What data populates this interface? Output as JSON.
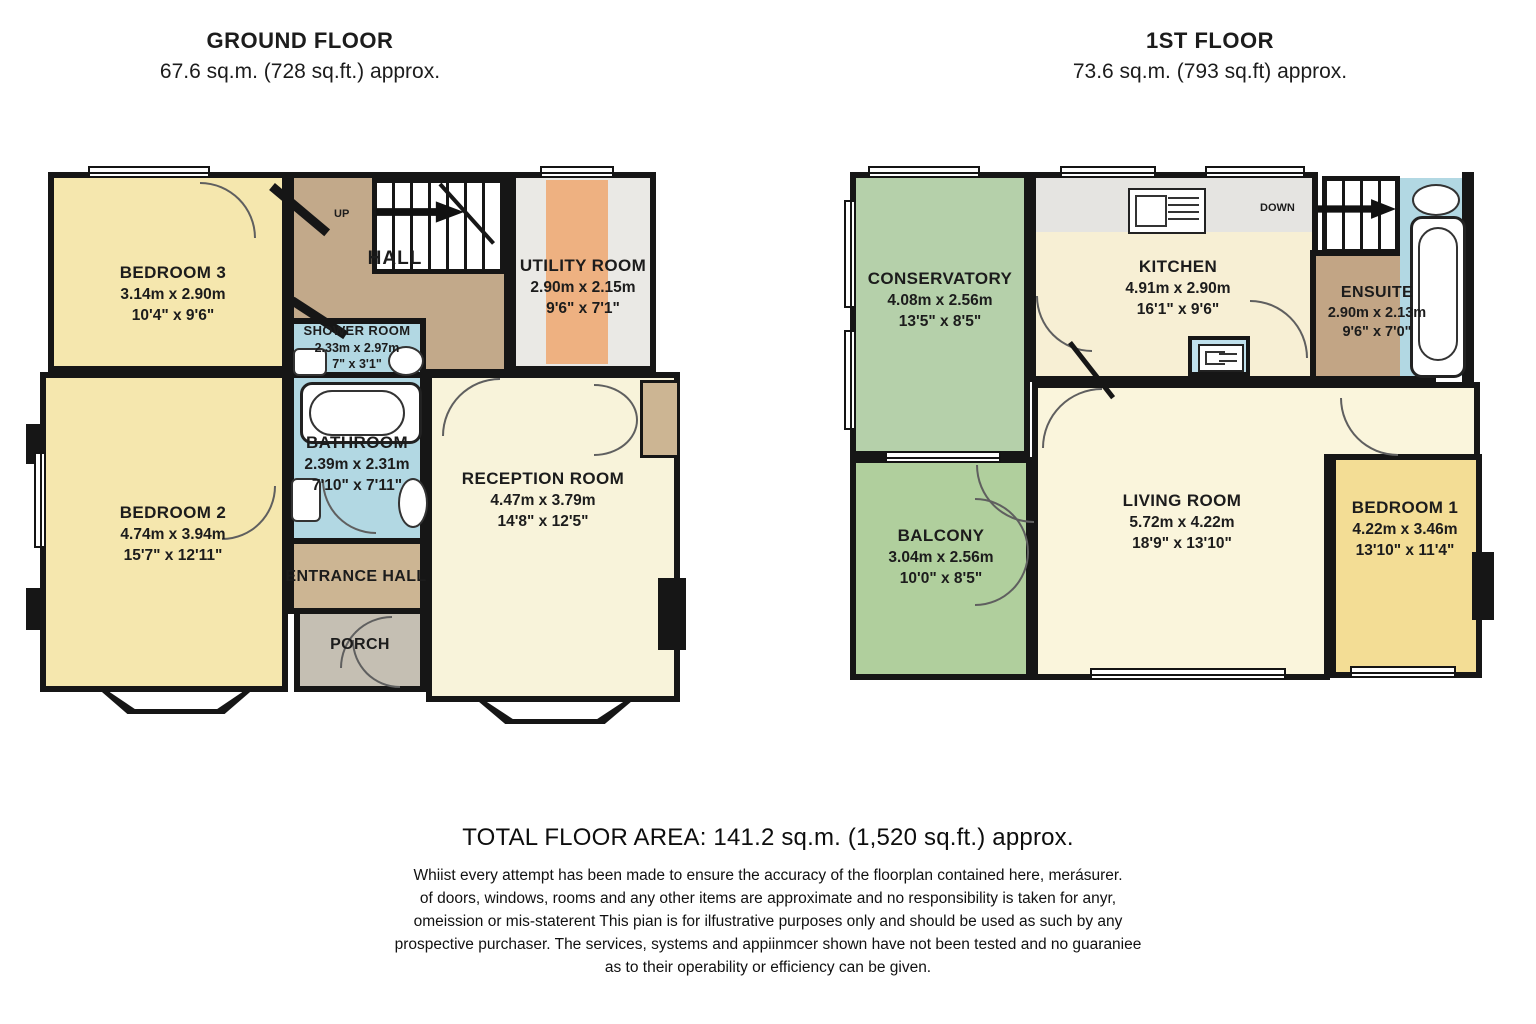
{
  "titles": {
    "ground": {
      "name": "GROUND FLOOR",
      "area": "67.6 sq.m. (728 sq.ft.) approx."
    },
    "first": {
      "name": "1ST FLOOR",
      "area": "73.6 sq.m. (793 sq.ft) approx."
    }
  },
  "ground_floor": {
    "bedroom3": {
      "name": "BEDROOM 3",
      "metric": "3.14m x 2.90m",
      "imperial": "10'4\" x 9'6\""
    },
    "hall": {
      "name": "HALL",
      "up_label": "UP"
    },
    "utility_room": {
      "name": "UTILITY ROOM",
      "metric": "2.90m x 2.15m",
      "imperial": "9'6\" x 7'1\""
    },
    "shower_room": {
      "name": "SHOWER ROOM",
      "metric": "2.33m x 2.97m",
      "imperial": "7\" x 3'1\""
    },
    "bathroom": {
      "name": "BATHROOM",
      "metric": "2.39m x 2.31m",
      "imperial": "7'10\" x 7'11\""
    },
    "bedroom2": {
      "name": "BEDROOM 2",
      "metric": "4.74m x 3.94m",
      "imperial": "15'7\" x 12'11\""
    },
    "entrance_hall": {
      "name": "ENTRANCE HALL"
    },
    "porch": {
      "name": "PORCH"
    },
    "reception_room": {
      "name": "RECEPTION ROOM",
      "metric": "4.47m x 3.79m",
      "imperial": "14'8\" x 12'5\""
    }
  },
  "first_floor": {
    "conservatory": {
      "name": "CONSERVATORY",
      "metric": "4.08m x 2.56m",
      "imperial": "13'5\" x 8'5\""
    },
    "kitchen": {
      "name": "KITCHEN",
      "metric": "4.91m x 2.90m",
      "imperial": "16'1\" x 9'6\""
    },
    "stairs": {
      "down_label": "DOWN"
    },
    "ensuite": {
      "name": "ENSUITE",
      "metric": "2.90m x 2.13m",
      "imperial": "9'6\" x 7'0\""
    },
    "balcony": {
      "name": "BALCONY",
      "metric": "3.04m x 2.56m",
      "imperial": "10'0\" x 8'5\""
    },
    "living_room": {
      "name": "LIVING ROOM",
      "metric": "5.72m x 4.22m",
      "imperial": "18'9\" x 13'10\""
    },
    "bedroom1": {
      "name": "BEDROOM 1",
      "metric": "4.22m x 3.46m",
      "imperial": "13'10\" x 11'4\""
    }
  },
  "footer": {
    "total_area": "TOTAL FLOOR AREA: 141.2 sq.m. (1,520 sq.ft.) approx.",
    "disclaimer": [
      "Whiist every attempt has been made to ensure the accuracy of the floorplan contained here, merásurer.",
      "of doors, windows, rooms and any other items are approximate and no responsibility is taken for anyr,",
      "omeission or mis-staterent This pian is for ilfustrative purposes only and should be used as such by any",
      "prospective purchaser. The services, systems and appiinmcer shown have not been tested and no guaraniee",
      "as to their operability or efficiency can be given."
    ]
  },
  "colors": {
    "wall": "#161616",
    "bedroom_yellow": "#f5e7ae",
    "bedroom1_yellow": "#f3dd95",
    "cream": "#f8f3da",
    "hall_tan": "#c2a98a",
    "entrance_tan": "#ccb593",
    "ensuite_tan": "#c2a585",
    "porch_grey": "#c5bfb3",
    "bath_blue": "#b2d8e3",
    "conservatory_green": "#b5d0aa",
    "balcony_green": "#b0cf9d",
    "utility_grey": "#eae9e5",
    "utility_orange": "#eeb181",
    "counter_grey": "#e5e4e1"
  }
}
